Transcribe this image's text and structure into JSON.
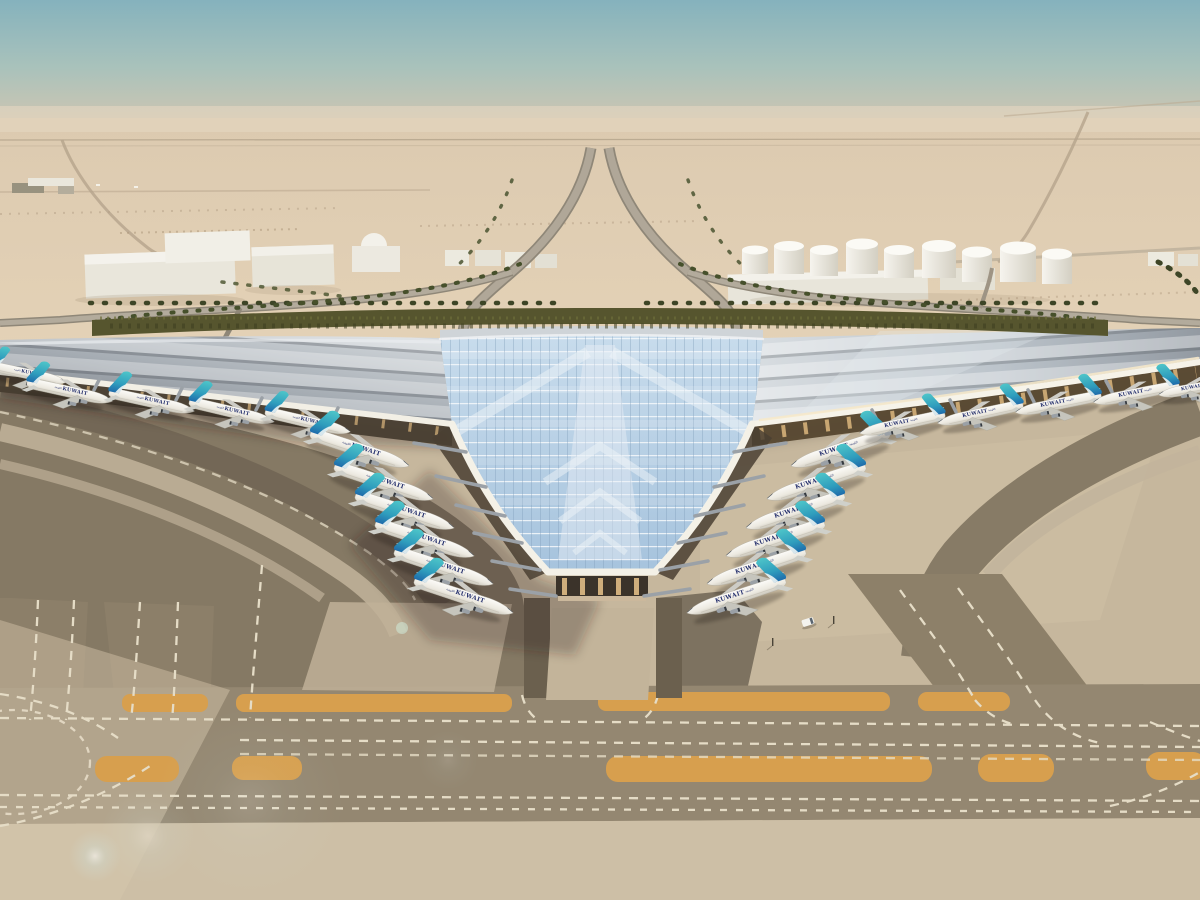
{
  "scene": {
    "subject": "Aerial architectural rendering of Kuwait International Airport new terminal in the desert",
    "airline": {
      "title_en": "KUWAIT",
      "title_ar": "الكويتية"
    },
    "aircraft": {
      "total_visible": 22,
      "left_pier_count": 6,
      "right_pier_count": 6,
      "left_wing_count": 5,
      "right_wing_count": 5,
      "tail_color": "#35aebc",
      "fuselage_color": "#f3f1ea",
      "title_color": "#26316e"
    },
    "terminal": {
      "roof_style": "swept trident canopy",
      "glass_color": "#b6d0e4",
      "roof_color": "#aeb5bd",
      "fascia_color": "#f2efe5"
    },
    "ground": {
      "apron_color": "#c6b79d",
      "asphalt_color": "#857964",
      "taxiway_stripe_color": "#d79f4e",
      "marking_color": "#e5dcc6"
    },
    "sky": {
      "top": "#8cb6bf",
      "horizon": "#dacdb8"
    },
    "landscape": {
      "hedge_color": "#56552e",
      "palm_color": "#3d4526"
    },
    "vehicles": {
      "service_van_count": 1
    }
  }
}
